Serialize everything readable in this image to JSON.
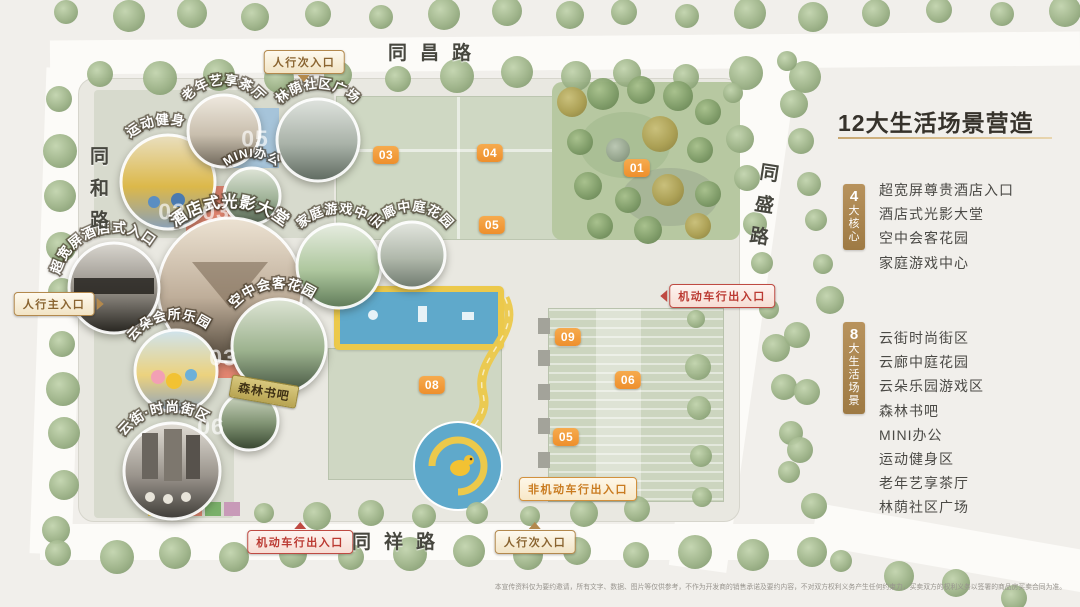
{
  "title": {
    "text": "12大生活场景营造"
  },
  "legend": {
    "badge_color": "#ab8756",
    "groups": [
      {
        "badge_number": "4",
        "badge_label": "大核心",
        "items": [
          "超宽屏尊贵酒店入口",
          "酒店式光影大堂",
          "空中会客花园",
          "家庭游戏中心"
        ]
      },
      {
        "badge_number": "8",
        "badge_label": "大生活场景",
        "items": [
          "云街时尚街区",
          "云廊中庭花园",
          "云朵乐园游戏区",
          "森林书吧",
          "MINI办公",
          "运动健身区",
          "老年艺享茶厅",
          "林荫社区广场"
        ]
      }
    ]
  },
  "roads": [
    {
      "id": "tongchang",
      "label": "同昌路"
    },
    {
      "id": "tonghe",
      "label": "同和路"
    },
    {
      "id": "tongsheng",
      "label": "同盛路"
    },
    {
      "id": "tongxiang",
      "label": "同祥路"
    }
  ],
  "entrances": [
    {
      "label": "人行次入口",
      "variant": "gold",
      "arrow": "down",
      "x": 304,
      "y": 62
    },
    {
      "label": "人行主入口",
      "variant": "gold",
      "arrow": "right",
      "x": 54,
      "y": 304
    },
    {
      "label": "机动车行出入口",
      "variant": "red",
      "arrow": "left",
      "x": 722,
      "y": 296
    },
    {
      "label": "非机动车行出入口",
      "variant": "orange",
      "arrow": "none",
      "x": 578,
      "y": 489
    },
    {
      "label": "机动车行出入口",
      "variant": "red",
      "arrow": "up",
      "x": 300,
      "y": 542
    },
    {
      "label": "人行次入口",
      "variant": "gold",
      "arrow": "up",
      "x": 535,
      "y": 542
    }
  ],
  "building_numbers": [
    {
      "label": "01",
      "x": 637,
      "y": 168
    },
    {
      "label": "03",
      "x": 386,
      "y": 155
    },
    {
      "label": "04",
      "x": 490,
      "y": 153
    },
    {
      "label": "05",
      "x": 492,
      "y": 225
    },
    {
      "label": "08",
      "x": 432,
      "y": 385
    },
    {
      "label": "09",
      "x": 568,
      "y": 337
    },
    {
      "label": "06",
      "x": 628,
      "y": 380
    },
    {
      "label": "05",
      "x": 566,
      "y": 437
    }
  ],
  "faint_numbers": [
    {
      "label": "02",
      "x": 172,
      "y": 212
    },
    {
      "label": "03",
      "x": 216,
      "y": 212
    },
    {
      "label": "05",
      "x": 255,
      "y": 139
    },
    {
      "label": "03",
      "x": 223,
      "y": 358
    },
    {
      "label": "06",
      "x": 211,
      "y": 427
    }
  ],
  "callouts": [
    {
      "id": "sports",
      "label": "运动健身",
      "label_style": "curved",
      "x": 168,
      "y": 182,
      "r": 47,
      "photo": [
        "#e9dfc0",
        "#dcb84a",
        "#8aa0b8"
      ]
    },
    {
      "id": "tea",
      "label": "老年艺享茶厅",
      "label_style": "curved",
      "x": 224,
      "y": 131,
      "r": 36,
      "photo": [
        "#efe9df",
        "#c9bfae",
        "#6f675a"
      ]
    },
    {
      "id": "plaza",
      "label": "林荫社区广场",
      "label_style": "curved",
      "x": 318,
      "y": 140,
      "r": 41,
      "photo": [
        "#dfe3de",
        "#a9b2a8",
        "#5f6a60"
      ]
    },
    {
      "id": "mini-office",
      "label": "MINI办公",
      "label_style": "curved",
      "x": 252,
      "y": 196,
      "r": 28,
      "photo": [
        "#dfe5d8",
        "#9fb297",
        "#51604e"
      ]
    },
    {
      "id": "hotel-lobby",
      "label": "酒店式光影大堂",
      "label_style": "curved",
      "x": 230,
      "y": 290,
      "r": 72,
      "photo": [
        "#ece2d2",
        "#bfae9a",
        "#4f4538"
      ]
    },
    {
      "id": "hotel-entry",
      "label": "超宽屏酒店式入口",
      "label_style": "curved",
      "x": 114,
      "y": 288,
      "r": 45,
      "photo": [
        "#d9d6cf",
        "#8f8a82",
        "#26241f"
      ]
    },
    {
      "id": "family-game",
      "label": "家庭游戏中心",
      "label_style": "curved",
      "x": 339,
      "y": 266,
      "r": 42,
      "photo": [
        "#e6ece0",
        "#aec79e",
        "#5f7a58"
      ]
    },
    {
      "id": "cloud-corridor",
      "label": "云廊中庭花园",
      "label_style": "curved",
      "x": 412,
      "y": 255,
      "r": 33,
      "photo": [
        "#e3e6df",
        "#b0b8ab",
        "#6f7a6e"
      ]
    },
    {
      "id": "sky-garden",
      "label": "空中会客花园",
      "label_style": "curved",
      "x": 279,
      "y": 346,
      "r": 47,
      "photo": [
        "#dde4d4",
        "#9cb28e",
        "#43533f"
      ]
    },
    {
      "id": "cloud-club",
      "label": "云朵会所乐园",
      "label_style": "curved",
      "x": 176,
      "y": 371,
      "r": 41,
      "photo": [
        "#cfe3ee",
        "#ecd27e",
        "#8fa3bb"
      ]
    },
    {
      "id": "forest-book",
      "label": "森林书吧",
      "label_style": "badge",
      "x": 249,
      "y": 421,
      "r": 29,
      "photo": [
        "#d4dcc8",
        "#7f9272",
        "#36452f"
      ]
    },
    {
      "id": "cloud-street",
      "label": "云街·时尚街区",
      "label_style": "curved",
      "x": 172,
      "y": 471,
      "r": 48,
      "photo": [
        "#e0dcd4",
        "#9a948c",
        "#3f3c38"
      ]
    }
  ],
  "colors": {
    "number_badge": "#ee8f2c",
    "entrance_gold": "#b3894d",
    "entrance_red": "#bf4a42",
    "entrance_orange": "#d2913e",
    "legend_badge": "#ab8756",
    "park_green": "#b7c8a1",
    "playground_blue": "#5fa9cb",
    "playground_yellow": "#ecc94b"
  },
  "disclaimer": "本宣传资料仅为要约邀请，所有文字、数据、图片等仅供参考，不作为开发商的销售承诺及要约内容，不对双方权利义务产生任何约束力，买卖双方的权利义务以签署的商品房买卖合同为准。"
}
